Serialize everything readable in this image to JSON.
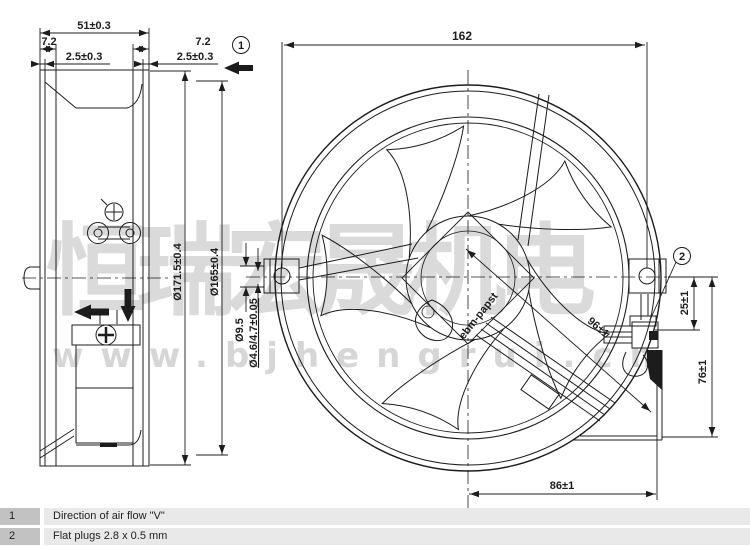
{
  "drawing": {
    "side_view": {
      "dims": {
        "overall_depth": "51±0.3",
        "flange_depth_left": "7.2",
        "flange_lip_left": "2.5±0.3",
        "flange_depth_right": "7.2",
        "flange_lip_right": "2.5±0.3",
        "outer_diameter": "Ø171.5±0.4",
        "venturi_diameter": "Ø165±0.4"
      }
    },
    "front_view": {
      "dims": {
        "mounting_hole_spacing": "162",
        "mounting_boss_diameter": "Ø9.5",
        "mounting_hole_diameter": "Ø4.6/4.7±0.05",
        "plug_diagonal_distance": "96±1",
        "plug_vertical_offset": "25±1",
        "plug_vertical_extent": "76±1",
        "plug_horizontal_offset": "86±1"
      },
      "hub_label": "ebm-papst"
    },
    "callouts": {
      "airflow": "1",
      "plugs": "2"
    }
  },
  "legend": {
    "rows": [
      {
        "ref": "1",
        "text": "Direction of air flow \"V\""
      },
      {
        "ref": "2",
        "text": "Flat plugs 2.8 x 0.5 mm"
      }
    ]
  },
  "watermark": {
    "company": "恒瑞宏晟机电",
    "url": "www.bjhengrui.cn"
  },
  "colors": {
    "line": "#1c1c1c",
    "legend_ref_bg": "#c2c2c2",
    "legend_row_bg": "#e9e9e9",
    "watermark_gray": "#d8d8d8"
  }
}
